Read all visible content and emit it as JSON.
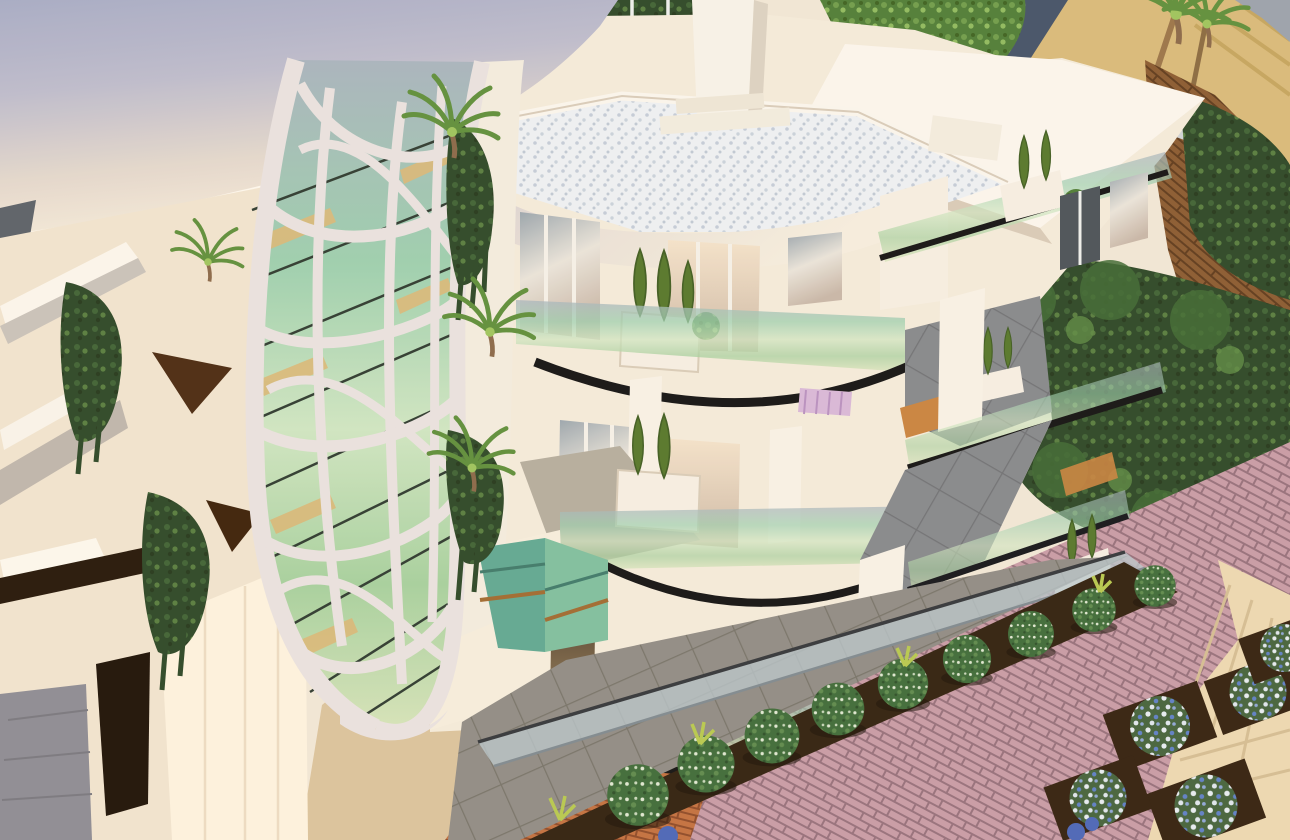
{
  "scene": {
    "type": "architectural-3d-render",
    "description": "Aerial sunset view of a modern white apartment building with an organic white lattice facade over green glass, curved glass balconies with black handrails, grey tiled terraces, rooftop pebble deck, planters with conical shrubs and ivy, surrounded by landscaped gardens, round bushes, flower beds, pink brick and cream stone paving, sand and palm trees in the background",
    "visible_text": ""
  },
  "palette": {
    "tower_top": "#a6abc6",
    "building_white": "#f4ebdb",
    "building_bright": "#fbf6ee",
    "facade_cream": "#f1e4cf",
    "wall_bright": "#fdf3df",
    "glass_green": "#9ccfae",
    "window_dark": "#4a5258",
    "handrail_black": "#121212",
    "rail_metal": "#b9c7cc",
    "tile_gray": "#85888c",
    "tile_warm": "#908c85",
    "pebble_white": "#eef1f4",
    "terracotta": "#c9833f",
    "cone_shrub_green": "#55772a",
    "ivy_dark": "#2c4726",
    "bush_green": "#3e6b38",
    "sand": "#d9ba7a",
    "soil": "#30200e",
    "tan_path": "#dbc39c",
    "brick_pink": "#c89ba6",
    "brick_orange": "#c2703f",
    "brick_brown": "#8a5a30",
    "path_cream": "#ecd9b2",
    "stairs_teal": "#5fa892",
    "wood_gold": "#d9b878",
    "roof_slate": "#435268",
    "gray_floor": "#8d8c94",
    "bed_pink": "#d8b8d8",
    "door_dark": "#3a2d20"
  },
  "elements": [
    {
      "name": "curved-white-tower",
      "desc": "large smooth cylindrical tower upper-left, lavender-grey to cream"
    },
    {
      "name": "organic-lattice-facade",
      "desc": "white voronoi-like web over green glazing, full height band"
    },
    {
      "name": "left-facade-panels",
      "desc": "angular white panels with dark triangular shadow openings"
    },
    {
      "name": "rooftop-deck",
      "desc": "white pebble roof terrace with parapets and service pillar"
    },
    {
      "name": "curved-glass-balconies",
      "desc": "three stacked balconies with black curved handrails"
    },
    {
      "name": "right-wing-balconies",
      "desc": "stepped balconies with glass rails, white fins, planters"
    },
    {
      "name": "grey-tile-terraces",
      "desc": "large diagonal grey tile decks"
    },
    {
      "name": "teal-staircase",
      "desc": "small teal green stair block at garden level"
    },
    {
      "name": "garden",
      "desc": "soil strip with round speckled bushes and blue-white flower beds"
    },
    {
      "name": "paving",
      "desc": "pink brick, orange brick, cream stone path, tan walkway"
    },
    {
      "name": "background",
      "desc": "sand, palm trees, dark hedges, slate-roof house, brown drive"
    }
  ]
}
